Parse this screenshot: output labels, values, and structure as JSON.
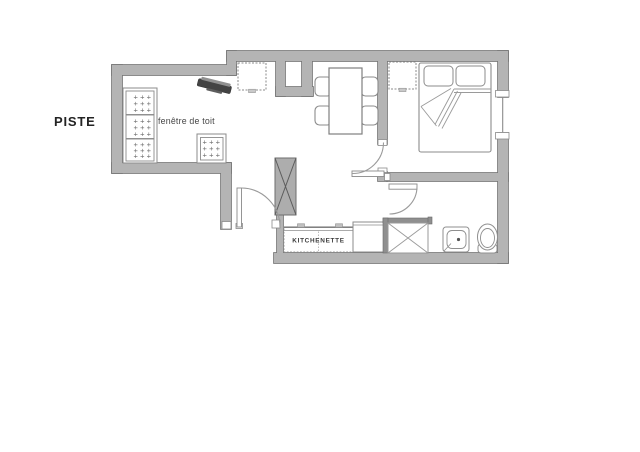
{
  "labels": {
    "piste": "PISTE",
    "roof_window": "fenêtre de toit",
    "kitchenette": "KITCHENETTE"
  },
  "pattern": {
    "row": "+++"
  },
  "colors": {
    "background": "#ffffff",
    "wall_fill": "#b4b4b4",
    "wall_outline": "#777777",
    "furniture_line": "#8b8b8b",
    "shower_edge": "#8f8f8f",
    "column_fill": "#adadad",
    "tv_dark": "#434343",
    "text_dark": "#232323",
    "text_medium": "#464646"
  }
}
